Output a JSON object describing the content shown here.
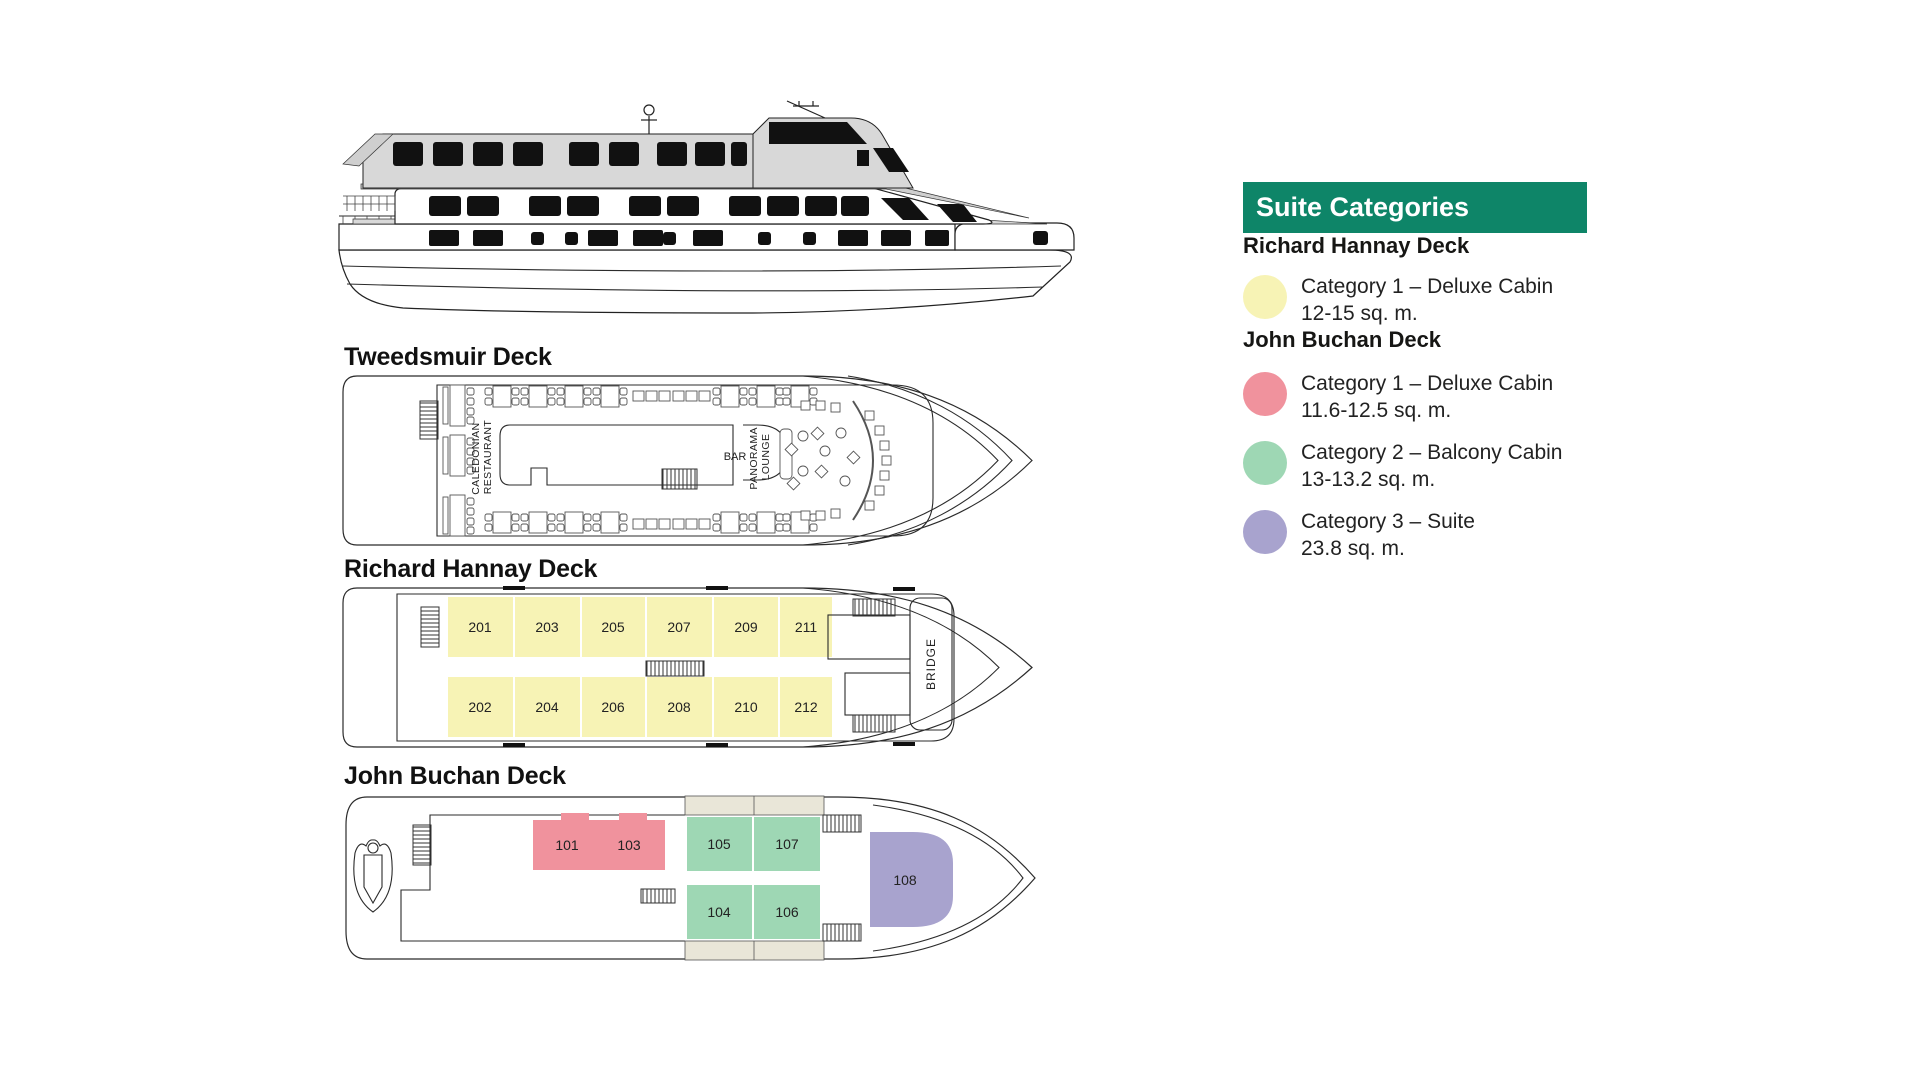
{
  "legend": {
    "title": "Suite Categories",
    "sections": [
      {
        "deck": "Richard Hannay Deck",
        "items": [
          {
            "swatch": "#f7f3b5",
            "category": "Category 1 – Deluxe Cabin",
            "size": "12-15 sq. m."
          }
        ]
      },
      {
        "deck": "John Buchan Deck",
        "items": [
          {
            "swatch": "#f0929d",
            "category": "Category 1 – Deluxe Cabin",
            "size": "11.6-12.5 sq. m."
          },
          {
            "swatch": "#9ed7b4",
            "category": "Category 2 – Balcony Cabin",
            "size": "13-13.2 sq. m."
          },
          {
            "swatch": "#a8a3ce",
            "category": "Category 3 – Suite",
            "size": "23.8 sq. m."
          }
        ]
      }
    ]
  },
  "colors": {
    "header_bg": "#0e8568",
    "deluxe_rh": "#f7f3b5",
    "deluxe_jb": "#f0929d",
    "balcony": "#9ed7b4",
    "suite": "#a8a3ce",
    "balcony_strip": "#e9e6d8"
  },
  "decks": {
    "tweedsmuir": {
      "title": "Tweedsmuir Deck",
      "restaurant_line1": "CALEDONIAN",
      "restaurant_line2": "RESTAURANT",
      "bar": "BAR",
      "lounge_line1": "PANORAMA",
      "lounge_line2": "LOUNGE"
    },
    "richard_hannay": {
      "title": "Richard Hannay Deck",
      "bridge": "BRIDGE",
      "cabins_top": [
        "201",
        "203",
        "205",
        "207",
        "209",
        "211"
      ],
      "cabins_bottom": [
        "202",
        "204",
        "206",
        "208",
        "210",
        "212"
      ]
    },
    "john_buchan": {
      "title": "John Buchan Deck",
      "deluxe_cabins": [
        "101",
        "103"
      ],
      "balcony_top": [
        "105",
        "107"
      ],
      "balcony_bottom": [
        "104",
        "106"
      ],
      "suite": "108"
    }
  }
}
